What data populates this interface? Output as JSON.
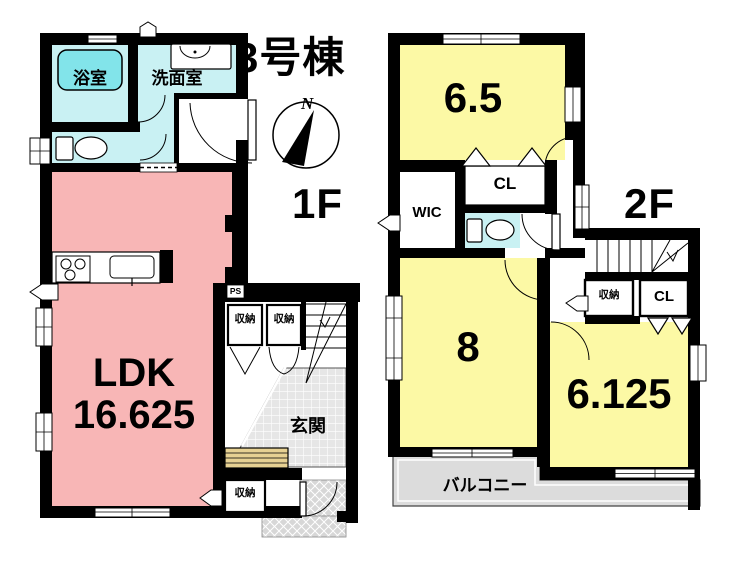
{
  "title": "3号棟",
  "compass": {
    "north": "N"
  },
  "shared": {
    "storage": "収納",
    "closet": "CL"
  },
  "floors": {
    "f1": {
      "label": "1F",
      "rooms": {
        "bath": "浴室",
        "washroom": "洗面室",
        "ldk": "LDK",
        "ldk_area": "16.625",
        "genkan": "玄関",
        "ps": "PS"
      }
    },
    "f2": {
      "label": "2F",
      "rooms": {
        "bedroom1_area": "6.5",
        "bedroom2_area": "8",
        "bedroom3_area": "6.125",
        "wic": "WIC",
        "balcony": "バルコニー"
      }
    }
  },
  "colors": {
    "wall": "#000000",
    "ldk_pink": "#f8b6b6",
    "room_yellow": "#fcf9a5",
    "wet_cyan": "#c9f1f3",
    "bathtub_cyan": "#82e4ea",
    "balcony_gray": "#dcdcdc",
    "genkan_gray": "#e6e6e6",
    "porch_gray": "#d7d7d7",
    "step_tan": "#e7d193"
  }
}
